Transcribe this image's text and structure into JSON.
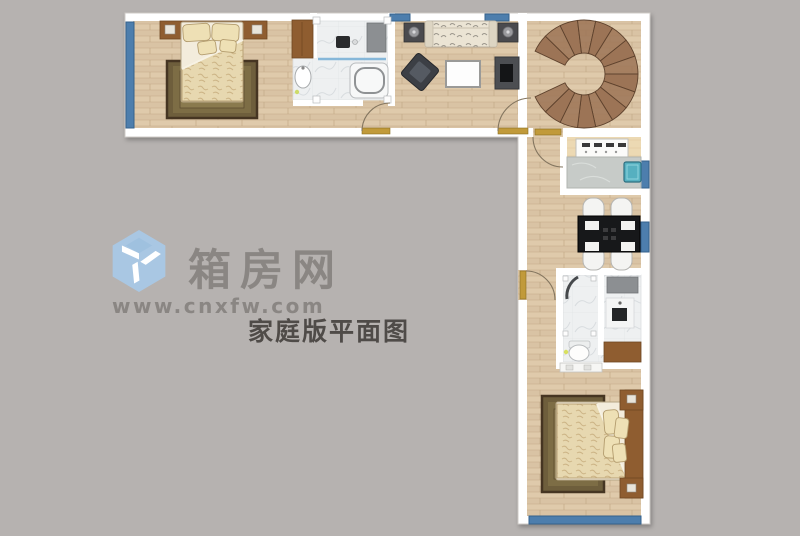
{
  "watermark": {
    "site_name": "箱房网",
    "site_url": "www.cnxfw.com",
    "caption": "家庭版平面图",
    "logo": "cube-logo"
  },
  "colors": {
    "background": "#b6b2b0",
    "wall": "#ffffff",
    "window_blue": "#4d7ead",
    "stair_brown": "#9c7456",
    "door_gold": "#c19a3a",
    "furniture_brown": "#8f5d30",
    "wood_floor": "#d9c3a4",
    "kitchen_floor": "#ecd9b3",
    "tile_floor": "#eef0f1",
    "sink_teal": "#56b0c0",
    "logo_blue": "#a9c7e3",
    "watermark_gray": "#8a8683",
    "caption_gray": "#4f4b48"
  },
  "floor_plan": {
    "type": "floor-plan",
    "shape": "L-shaped",
    "rooms": [
      {
        "name": "bedroom-1",
        "items": [
          "double-bed",
          "pillows",
          "rug",
          "headboard-with-nightstands",
          "wardrobe"
        ]
      },
      {
        "name": "bathroom-1",
        "items": [
          "shower-mat",
          "toilet",
          "washbasin",
          "bathtub",
          "glass-divider"
        ]
      },
      {
        "name": "living-room",
        "items": [
          "sofa",
          "side-table-lamp-left",
          "side-table-lamp-right",
          "armchair",
          "coffee-table",
          "tv-stand"
        ]
      },
      {
        "name": "stair-hall",
        "items": [
          "spiral-staircase"
        ]
      },
      {
        "name": "kitchen",
        "items": [
          "stove",
          "counter",
          "sink"
        ]
      },
      {
        "name": "dining-area",
        "items": [
          "dining-table",
          "chairs-x4"
        ]
      },
      {
        "name": "bathroom-2",
        "items": [
          "shower-cabin",
          "toilet",
          "shower-column",
          "vanity-cabinet",
          "washbasin-counter"
        ]
      },
      {
        "name": "bedroom-2",
        "items": [
          "double-bed",
          "pillows",
          "rug",
          "headboard-with-nightstands"
        ]
      }
    ],
    "windows": 6,
    "doors": 4
  }
}
